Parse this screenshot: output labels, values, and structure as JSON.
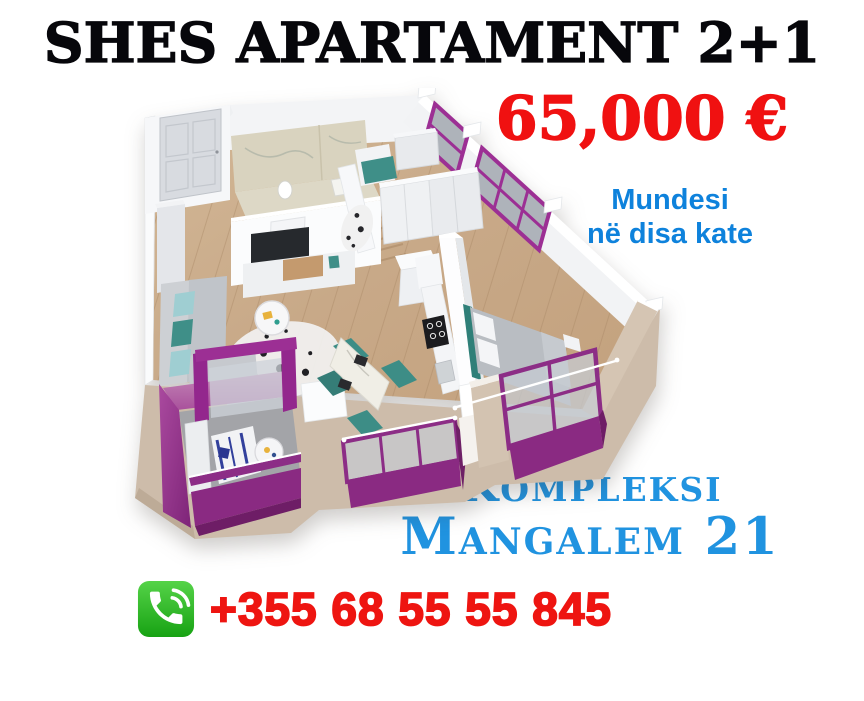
{
  "headline": {
    "title": "SHES APARTAMENT 2+1",
    "color": "#07070b"
  },
  "price": {
    "amount": "65,000 €",
    "color": "#f01111"
  },
  "availability": {
    "line1": "Mundesi",
    "line2": "në disa kate",
    "color": "#0e82dc"
  },
  "complex": {
    "line1": "Kompleksi",
    "line2": "Mangalem 21",
    "color": "#2093e0"
  },
  "contact": {
    "phone": "+355 68 55 55 845",
    "phone_color": "#ee1511",
    "icon": "phone-call-icon",
    "icon_color": "#2eb82a"
  },
  "floorplan": {
    "alt": "3D cutaway floor plan of a 2+1 apartment",
    "accent_purple": "#93278d",
    "wall_white": "#f7f8fa",
    "floor_wood": "#c9ab8b",
    "exterior_beige": "#d2c2b0",
    "teal_accent": "#3f8f88",
    "balcony_count": 3
  }
}
